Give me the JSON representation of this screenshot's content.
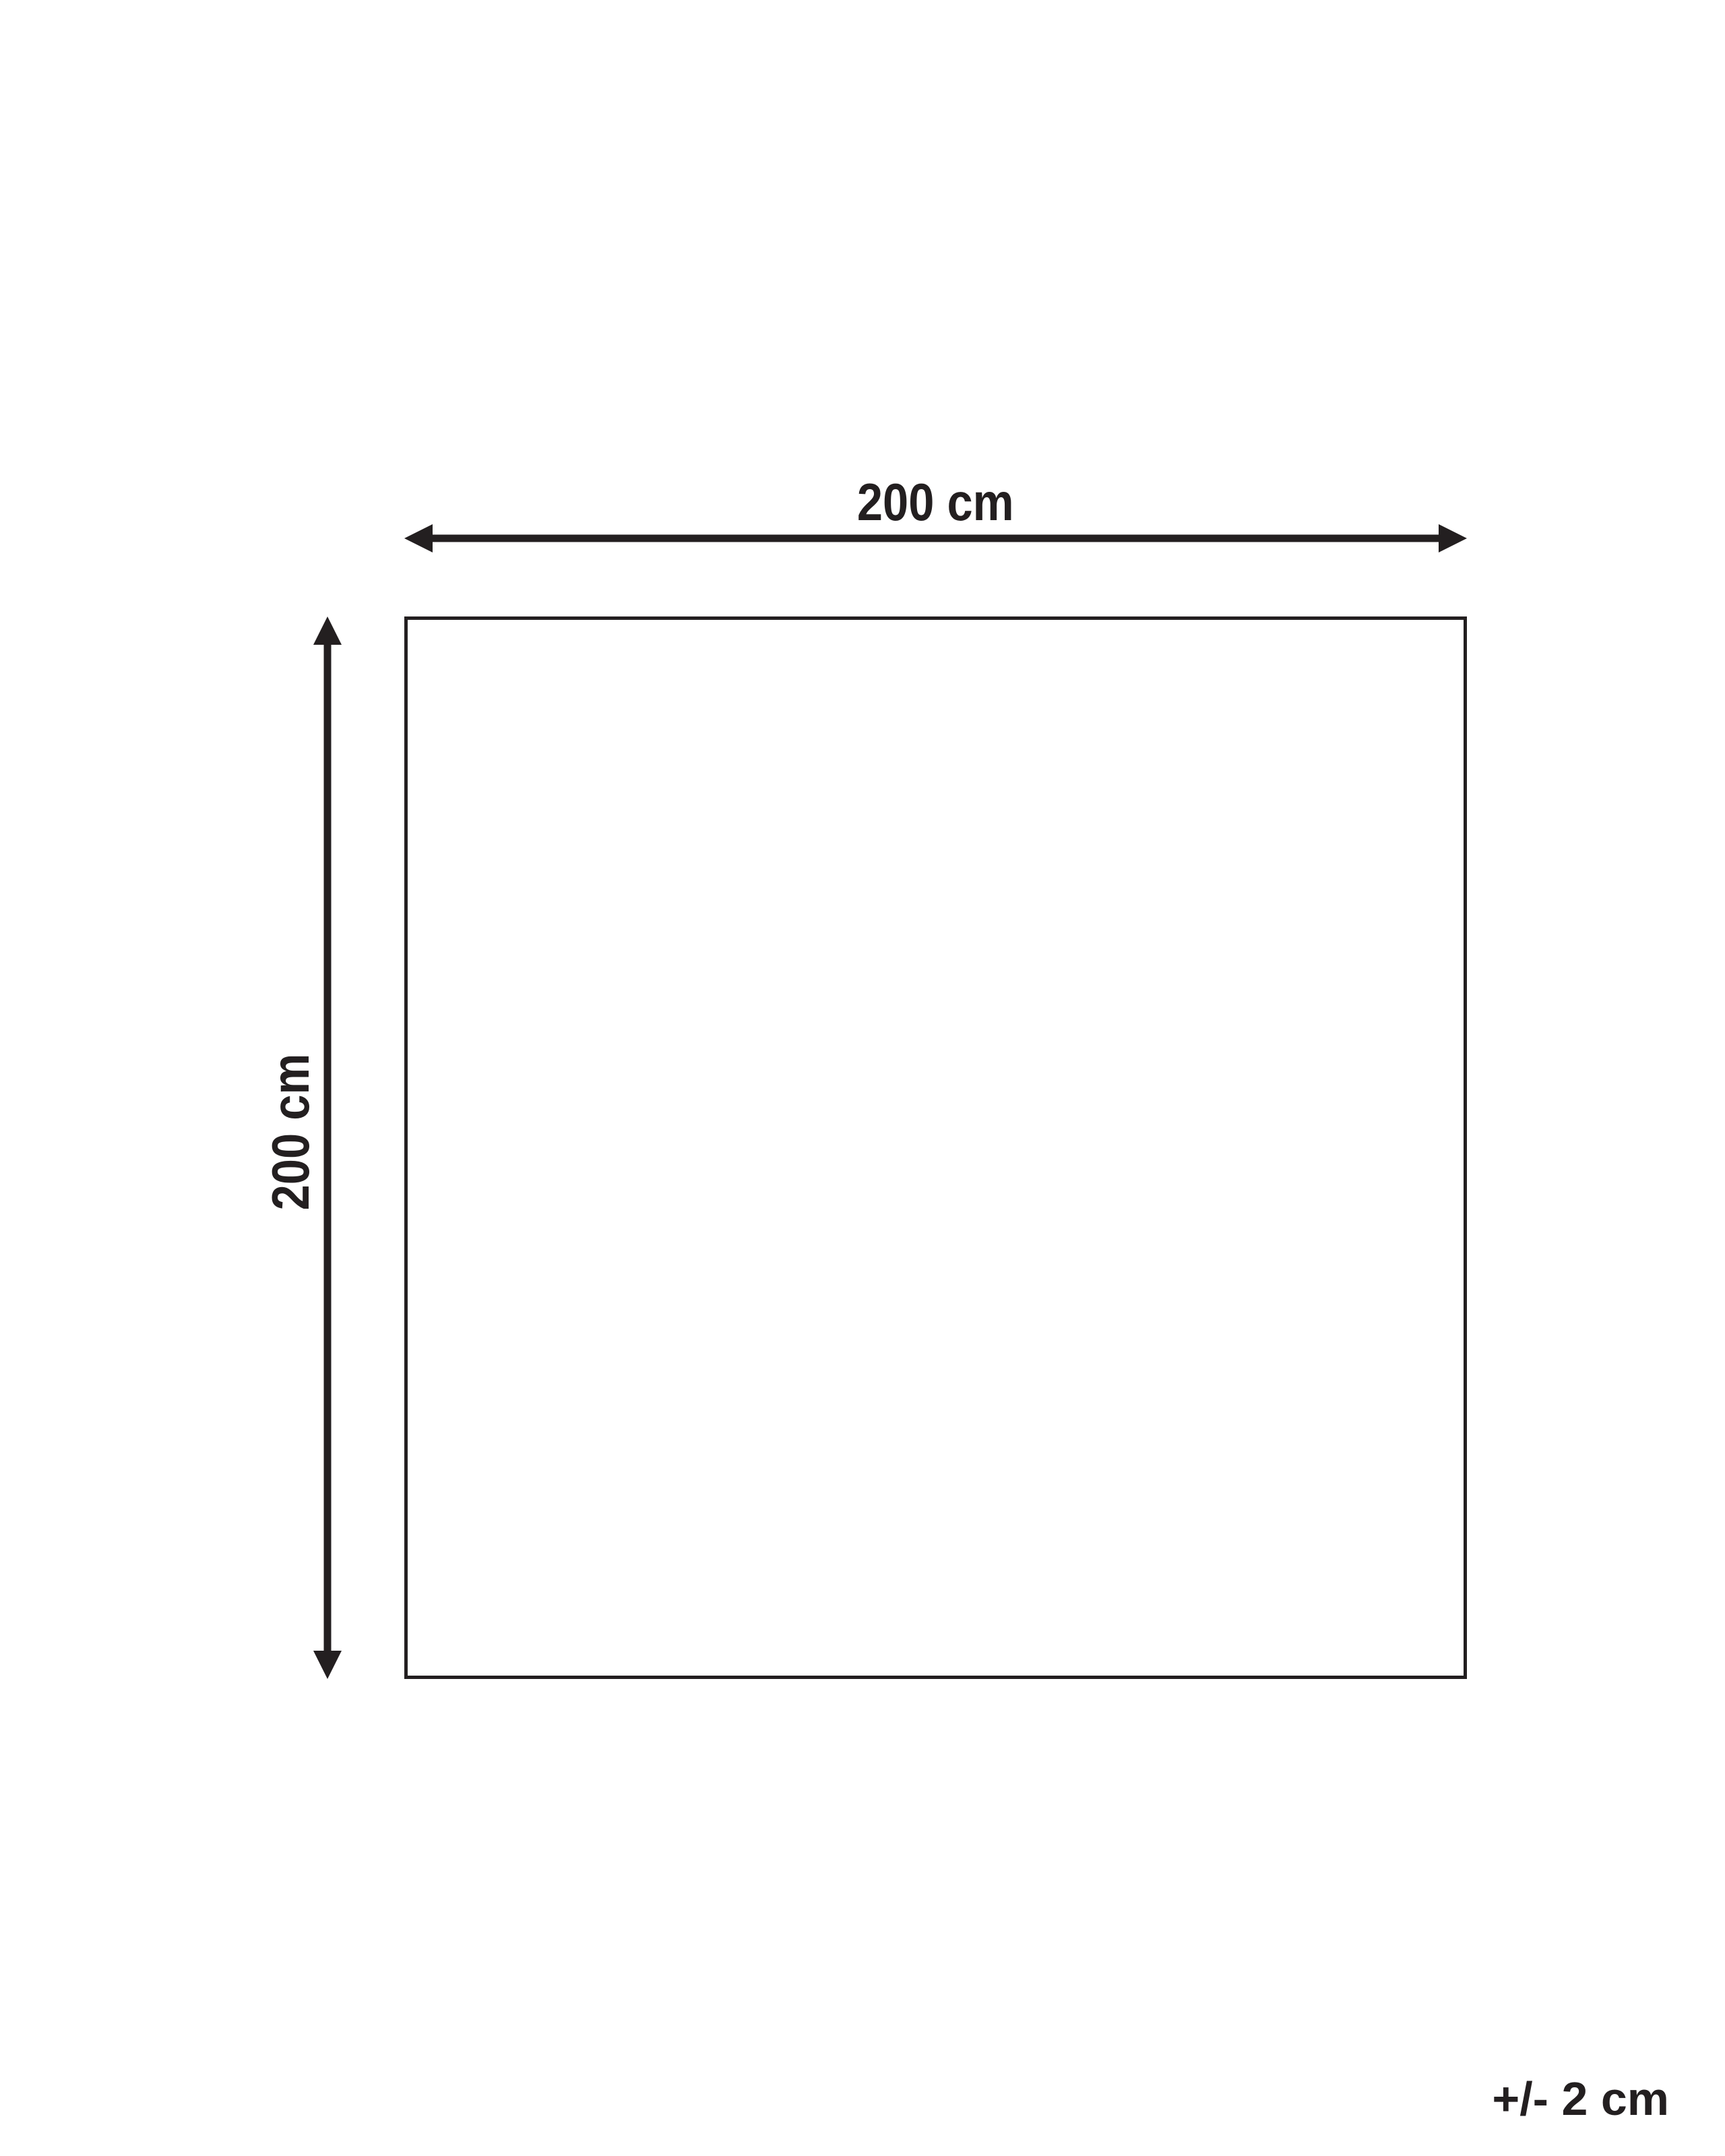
{
  "diagram": {
    "kind": "product-dimension-diagram",
    "width_label": "200 cm",
    "height_label": "200 cm",
    "tolerance_label": "+/- 2 cm",
    "width_value_cm": 200,
    "height_value_cm": 200,
    "tolerance_cm": 2,
    "ink_color": "#231f20",
    "background_color": "#ffffff"
  }
}
